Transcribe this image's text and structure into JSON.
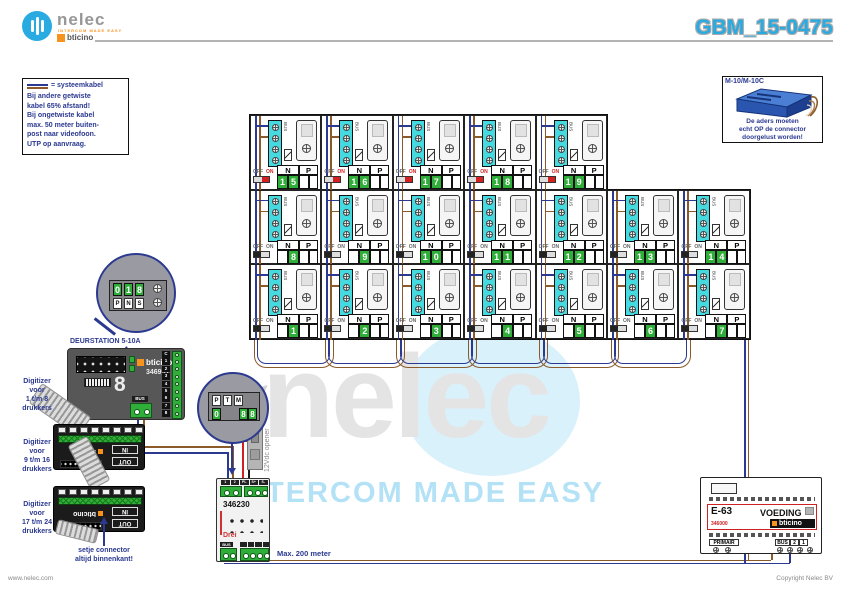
{
  "header": {
    "logo_name": "nelec",
    "logo_tagline": "INTERCOM MADE EASY",
    "logo_partner": "bticino",
    "doc_number": "GBM_15-0475"
  },
  "note_box": {
    "legend_label": "= systeemkabel",
    "lines": [
      "Bij andere getwiste",
      "kabel 65% afstand!",
      "Bij ongetwiste kabel",
      "max. 50 meter buiten-",
      "post naar videofoon.",
      "UTP op aanvraag."
    ]
  },
  "connector_box": {
    "title": "M-10/M-10C",
    "warning_lines": [
      "De aders moeten",
      "echt OP de connector",
      "doorgelust worden!"
    ]
  },
  "grid": {
    "col_header_n": "N",
    "col_header_p": "P",
    "off_label": "OFF",
    "on_label": "ON",
    "bus_label": "BUS",
    "rows": [
      {
        "switch_state": "on",
        "units": [
          15,
          16,
          17,
          18,
          19
        ]
      },
      {
        "switch_state": "off",
        "units": [
          8,
          9,
          10,
          11,
          12,
          13,
          14
        ]
      },
      {
        "switch_state": "off",
        "units": [
          1,
          2,
          3,
          4,
          5,
          6,
          7
        ]
      }
    ]
  },
  "magnifier_991": {
    "digits": [
      "0",
      "1",
      "8"
    ],
    "jumpers": [
      "P",
      "N",
      "S"
    ]
  },
  "magnifier_230": {
    "jumpers": [
      "P",
      "T",
      "M"
    ],
    "digits": [
      "0",
      "8",
      "8"
    ]
  },
  "deurstation_label": "DEURSTATION 5-10A",
  "digitizer_labels": [
    {
      "lines": [
        "Digitizer",
        "voor",
        "1 t/m 8",
        "drukkers"
      ]
    },
    {
      "lines": [
        "Digitizer",
        "voor",
        "9 t/m 16",
        "drukkers"
      ]
    },
    {
      "lines": [
        "Digitizer",
        "voor",
        "17 t/m 24",
        "drukkers"
      ]
    }
  ],
  "connector_note": [
    "setje connector",
    "altijd binnenkant!"
  ],
  "device_346991": {
    "brand": "bticino",
    "model": "346991",
    "terminals": [
      "C",
      "1",
      "2",
      "3",
      "4",
      "5",
      "6",
      "7",
      "8"
    ],
    "bus": "BUS"
  },
  "expansion_module": {
    "in_label": "IN",
    "out_label": "OUT",
    "brand": "bticino"
  },
  "opener_label": "12Vdc opener",
  "device_346230": {
    "model": "346230",
    "bus": "BUS",
    "top_terminals": [
      "1",
      "2",
      "PL",
      "S+",
      "S-"
    ],
    "red_mark": "Drei"
  },
  "power_supply": {
    "name": "E-63",
    "function": "VOEDING",
    "model": "346000",
    "brand": "bticino",
    "primair": "PRIMAIR",
    "bus_terminals": [
      "BUS",
      "2",
      "1"
    ]
  },
  "bus_note": "Max. 200 meter",
  "watermark": {
    "word": "nelec",
    "slogan": "INTERCOM MADE EASY"
  },
  "footer": {
    "left": "www.nelec.com",
    "right": "Copyright Nelec BV"
  },
  "colors": {
    "accent": "#29abe2",
    "dark_blue": "#2b3990",
    "wire_blue": "#2b3990",
    "wire_brown": "#8a5a2b",
    "terminal_cyan": "#45d9e0",
    "digit_green": "#2fae3a",
    "on_red": "#d42020",
    "bticino_orange": "#f7941d"
  }
}
